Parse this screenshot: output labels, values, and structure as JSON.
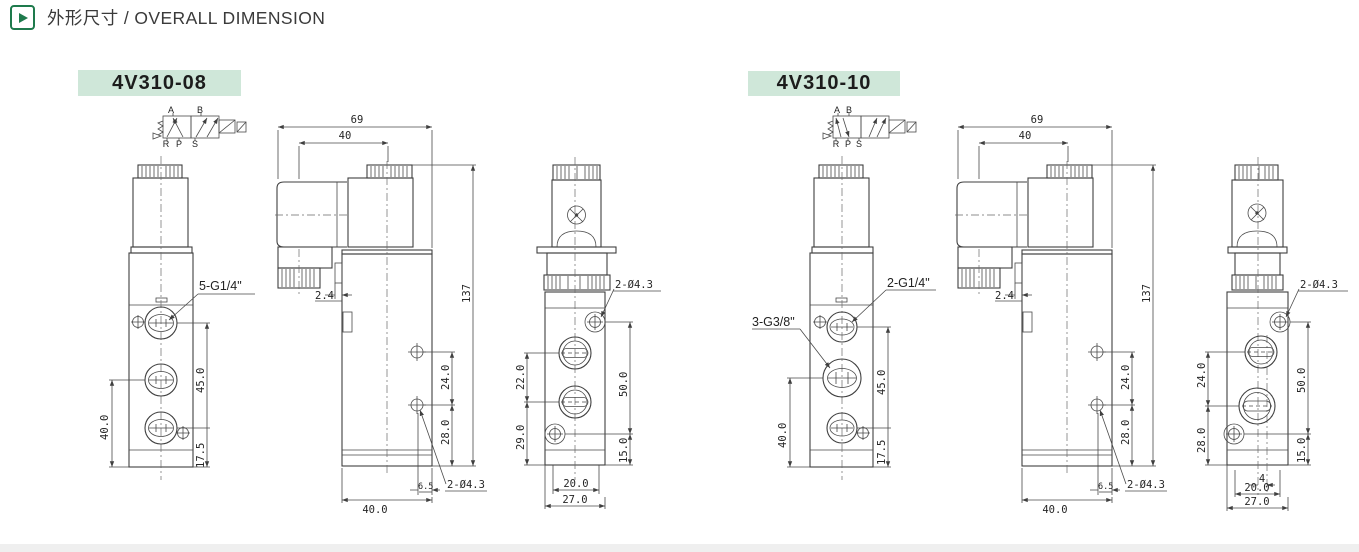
{
  "header": {
    "title": "外形尺寸 / OVERALL DIMENSION"
  },
  "colors": {
    "accent_green": "#1e7a4c",
    "label_bg": "#cfe7d9",
    "line": "#3f3f3f"
  },
  "left": {
    "model": "4V310-08",
    "symbol": {
      "a": "A",
      "b": "B",
      "r": "R",
      "p": "P",
      "s": "S"
    },
    "front": {
      "port_label": "5-G1/4\"",
      "dim_body": "40.0",
      "dim_ports": "45.0",
      "dim_bottom": "17.5"
    },
    "side": {
      "dim_width": "69",
      "dim_coil": "40",
      "dim_height": "137",
      "dim_tab": "2.4",
      "dim_holes": "24.0",
      "dim_hole_base": "28.0",
      "dim_edge": "6.5",
      "holes_label": "2-Ø4.3",
      "dim_base": "40.0"
    },
    "end": {
      "holes_label": "2-Ø4.3",
      "dim_ports": "22.0",
      "dim_port_base": "29.0",
      "dim_holes": "50.0",
      "dim_hole_base": "15.0",
      "dim_slot": "20.0",
      "dim_base": "27.0"
    }
  },
  "right": {
    "model": "4V310-10",
    "symbol": {
      "a": "A",
      "b": "B",
      "r": "R",
      "p": "P",
      "s": "S"
    },
    "front": {
      "port_label_top": "2-G1/4\"",
      "port_label_mid": "3-G3/8\"",
      "dim_body": "40.0",
      "dim_ports": "45.0",
      "dim_bottom": "17.5"
    },
    "side": {
      "dim_width": "69",
      "dim_coil": "40",
      "dim_height": "137",
      "dim_tab": "2.4",
      "dim_holes": "24.0",
      "dim_hole_base": "28.0",
      "dim_edge": "6.5",
      "holes_label": "2-Ø4.3",
      "dim_base": "40.0"
    },
    "end": {
      "holes_label": "2-Ø4.3",
      "dim_ports": "24.0",
      "dim_port_base": "28.0",
      "dim_holes": "50.0",
      "dim_hole_base": "15.0",
      "dim_offset": "4",
      "dim_slot": "20.0",
      "dim_base": "27.0"
    }
  }
}
